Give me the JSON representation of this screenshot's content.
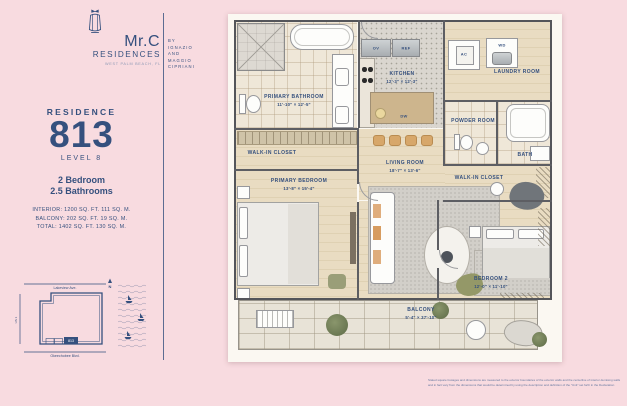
{
  "brand": {
    "name_primary": "Mr.C",
    "name_secondary": "RESIDENCES",
    "location": "WEST PALM BEACH, FL",
    "byline_lines": [
      "BY",
      "IGNAZIO",
      "AND",
      "MAGGIO",
      "CIPRIANI"
    ]
  },
  "residence": {
    "label": "RESIDENCE",
    "number": "813",
    "level": "LEVEL 8",
    "bedrooms": "2 Bedroom",
    "bathrooms": "2.5 Bathrooms",
    "area_interior": "INTERIOR: 1200 SQ. FT. 111 SQ. M.",
    "area_balcony": "BALCONY: 202 SQ. FT. 19 SQ. M.",
    "area_total": "TOTAL: 1402 SQ. FT. 130 SQ. M."
  },
  "plan": {
    "rooms": {
      "primary_bathroom": {
        "name": "PRIMARY BATHROOM",
        "dims": "11'-10\" × 12'-5\""
      },
      "walkin_left": {
        "name": "WALK-IN CLOSET"
      },
      "kitchen": {
        "name": "KITCHEN",
        "dims": "12'-3\" × 12'-3\""
      },
      "laundry": {
        "name": "LAUNDRY ROOM"
      },
      "powder": {
        "name": "POWDER ROOM"
      },
      "bath": {
        "name": "BATH"
      },
      "walkin_right": {
        "name": "WALK-IN CLOSET"
      },
      "living": {
        "name": "LIVING ROOM",
        "dims": "18'-7\" × 13'-6\""
      },
      "primary_bedroom": {
        "name": "PRIMARY BEDROOM",
        "dims": "13'-8\" × 15'-4\""
      },
      "bedroom2": {
        "name": "BEDROOM 2",
        "dims": "12'-0\" × 11'-10\""
      },
      "balcony": {
        "name": "BALCONY",
        "dims": "5'-4\" × 37'-10\""
      }
    },
    "appliances": {
      "ov": "OV",
      "ref": "REF",
      "dw": "DW",
      "ac": "AC",
      "wd": "WD"
    }
  },
  "site_plan": {
    "street_top": "Lakeview Ave.",
    "street_bottom": "Okeechobee Blvd.",
    "street_left": "US 1",
    "north_label": "N",
    "unit_marker": "813"
  },
  "disclaimer": "Stated square footages and dimensions are measured to the exterior boundaries of the exterior walls and the centerline of interior demising walls and in fact vary from the dimensions that would be determined by using the description and definition of the \"Unit\" set forth in the Declaration (which generally only includes the interior airspace between the perimeter walls and excludes all interior structural components and other common elements). Measurements of rooms set forth on this floor plan are generally taken at the greatest points of each given room (as if the room were a perfect rectangle), without regard for any cutouts or variations. Accordingly, the area of the actual room will typically be smaller than the product obtained by multiplying the stated length and width. All dimensions are approximate and may vary with actual construction.",
  "colors": {
    "background": "#f8dbe0",
    "navy": "#35507e",
    "paper": "#fbf8f2",
    "wood": "#e9dcc2"
  }
}
